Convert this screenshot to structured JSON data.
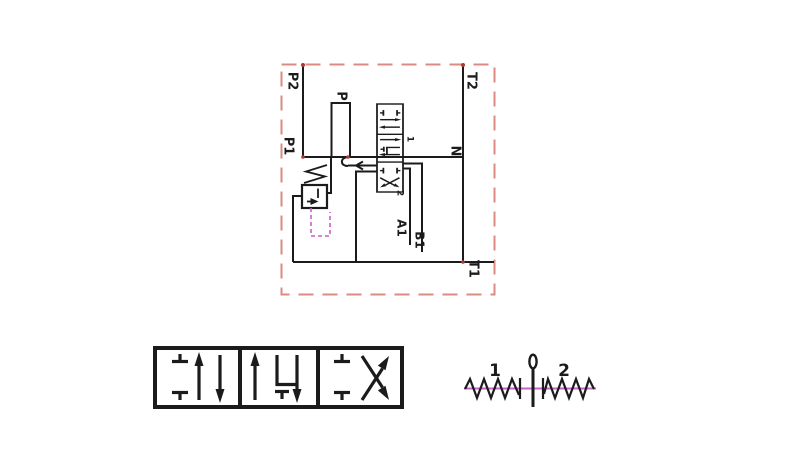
{
  "labels": {
    "p2": "P2",
    "p1": "P1",
    "p": "P",
    "t2": "T2",
    "n": "N",
    "t1": "T1",
    "a1": "A1",
    "b1": "B1",
    "pos1": "1",
    "pos2": "2",
    "lever_left": "1",
    "lever_right": "2"
  },
  "colors": {
    "line": "#1b1b1b",
    "border": "#db8b82",
    "dot": "#a93c30",
    "pilot": "#c95fc9",
    "background": "#ffffff"
  }
}
